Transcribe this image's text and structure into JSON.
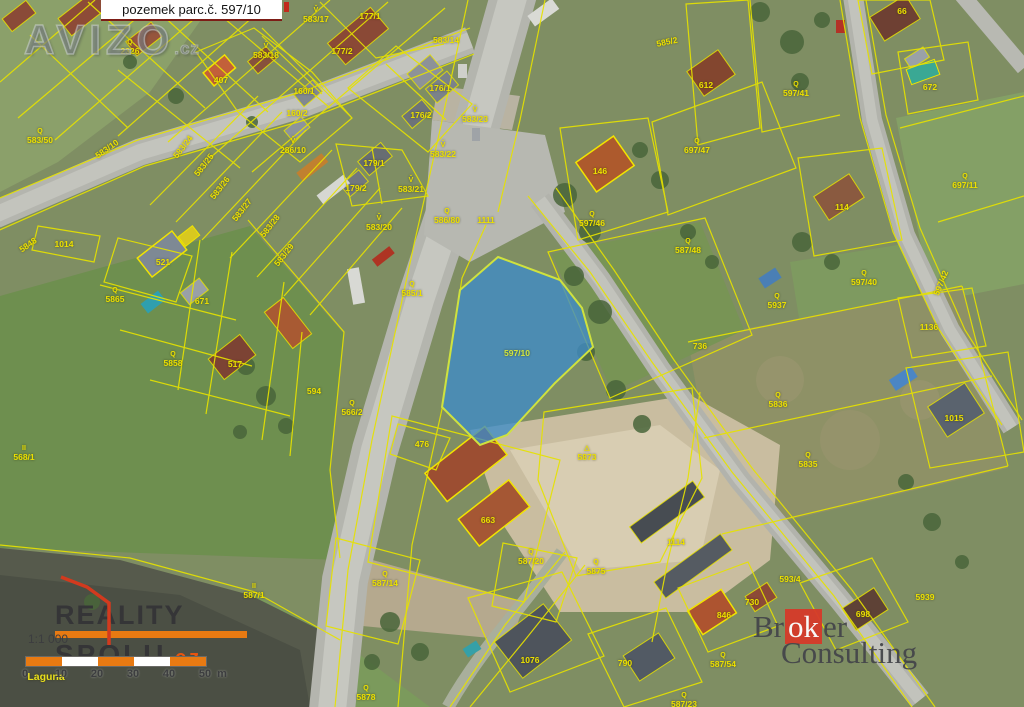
{
  "title_box": {
    "text": "pozemek parc.č. 597/10"
  },
  "watermark": {
    "brand": "AVIZO",
    "tld": ".cz"
  },
  "map": {
    "highlighted_parcel": "597/10",
    "colors": {
      "parcel_line": "#e6e200",
      "highlight_fill": "#3e8cc8",
      "highlight_stroke": "#cfe23e",
      "label": "#ece000"
    },
    "labels": [
      {
        "t": "2326",
        "x": 130,
        "y": 47,
        "s": "Q"
      },
      {
        "t": "583/50",
        "x": 40,
        "y": 136,
        "s": "Q"
      },
      {
        "t": "583/10",
        "x": 107,
        "y": 149,
        "r": -35
      },
      {
        "t": "583/17",
        "x": 316,
        "y": 15,
        "s": "V̌"
      },
      {
        "t": "177/1",
        "x": 370,
        "y": 16
      },
      {
        "t": "583/18",
        "x": 266,
        "y": 51,
        "s": "V̌"
      },
      {
        "t": "177/2",
        "x": 342,
        "y": 51
      },
      {
        "t": "407",
        "x": 221,
        "y": 80
      },
      {
        "t": "160/1",
        "x": 304,
        "y": 91
      },
      {
        "t": "160/2",
        "x": 297,
        "y": 113
      },
      {
        "t": "176/1",
        "x": 440,
        "y": 88
      },
      {
        "t": "176/2",
        "x": 421,
        "y": 115
      },
      {
        "t": "583/23",
        "x": 475,
        "y": 115,
        "s": "V̌"
      },
      {
        "t": "583/14",
        "x": 446,
        "y": 40
      },
      {
        "t": "585/2",
        "x": 667,
        "y": 42,
        "r": -12
      },
      {
        "t": "583/22",
        "x": 443,
        "y": 150,
        "s": "V̌"
      },
      {
        "t": "179/1",
        "x": 374,
        "y": 163
      },
      {
        "t": "179/2",
        "x": 356,
        "y": 188
      },
      {
        "t": "583/21",
        "x": 411,
        "y": 185,
        "s": "V̌"
      },
      {
        "t": "583/20",
        "x": 379,
        "y": 223,
        "s": "V̌"
      },
      {
        "t": "586/80",
        "x": 447,
        "y": 216,
        "s": "Q"
      },
      {
        "t": "1111",
        "x": 486,
        "y": 220
      },
      {
        "t": "585/1",
        "x": 412,
        "y": 289,
        "s": "Q"
      },
      {
        "t": "566/2",
        "x": 352,
        "y": 408,
        "s": "Q"
      },
      {
        "t": "568/1",
        "x": 24,
        "y": 453,
        "s": "II"
      },
      {
        "t": "587/1",
        "x": 254,
        "y": 591,
        "s": "II"
      },
      {
        "t": "1014",
        "x": 64,
        "y": 244
      },
      {
        "t": "5848",
        "x": 28,
        "y": 245,
        "r": -35
      },
      {
        "t": "583/24",
        "x": 183,
        "y": 147,
        "r": -52
      },
      {
        "t": "583/25",
        "x": 204,
        "y": 165,
        "r": -52
      },
      {
        "t": "583/26",
        "x": 220,
        "y": 188,
        "r": -52
      },
      {
        "t": "583/27",
        "x": 242,
        "y": 210,
        "r": -52
      },
      {
        "t": "583/28",
        "x": 270,
        "y": 226,
        "r": -52
      },
      {
        "t": "583/29",
        "x": 284,
        "y": 255,
        "r": -52
      },
      {
        "t": "286/10",
        "x": 293,
        "y": 146,
        "s": "V̌"
      },
      {
        "t": "5865",
        "x": 115,
        "y": 295,
        "s": "Q"
      },
      {
        "t": "671",
        "x": 202,
        "y": 301
      },
      {
        "t": "5858",
        "x": 173,
        "y": 359,
        "s": "Q"
      },
      {
        "t": "517",
        "x": 235,
        "y": 364
      },
      {
        "t": "594",
        "x": 314,
        "y": 391
      },
      {
        "t": "521",
        "x": 163,
        "y": 262
      },
      {
        "t": "146",
        "x": 600,
        "y": 171
      },
      {
        "t": "697/47",
        "x": 697,
        "y": 146,
        "s": "Q"
      },
      {
        "t": "597/46",
        "x": 592,
        "y": 219,
        "s": "Q"
      },
      {
        "t": "587/48",
        "x": 688,
        "y": 246,
        "s": "Q"
      },
      {
        "t": "612",
        "x": 706,
        "y": 85
      },
      {
        "t": "597/41",
        "x": 796,
        "y": 89,
        "s": "Q"
      },
      {
        "t": "66",
        "x": 902,
        "y": 11
      },
      {
        "t": "672",
        "x": 930,
        "y": 87
      },
      {
        "t": "697/11",
        "x": 965,
        "y": 181,
        "s": "Q"
      },
      {
        "t": "114",
        "x": 842,
        "y": 207
      },
      {
        "t": "597/40",
        "x": 864,
        "y": 278,
        "s": "Q"
      },
      {
        "t": "5937",
        "x": 777,
        "y": 301,
        "s": "Q"
      },
      {
        "t": "1136",
        "x": 929,
        "y": 327
      },
      {
        "t": "597/42",
        "x": 941,
        "y": 283,
        "r": -68
      },
      {
        "t": "5836",
        "x": 778,
        "y": 400,
        "s": "Q"
      },
      {
        "t": "5835",
        "x": 808,
        "y": 460,
        "s": "Q"
      },
      {
        "t": "1015",
        "x": 954,
        "y": 418
      },
      {
        "t": "736",
        "x": 700,
        "y": 346
      },
      {
        "t": "5873",
        "x": 587,
        "y": 453,
        "s": "△"
      },
      {
        "t": "5875",
        "x": 596,
        "y": 567,
        "s": "Q"
      },
      {
        "t": "587/20",
        "x": 531,
        "y": 557,
        "s": "Q"
      },
      {
        "t": "663",
        "x": 488,
        "y": 520
      },
      {
        "t": "476",
        "x": 422,
        "y": 444
      },
      {
        "t": "587/14",
        "x": 385,
        "y": 579,
        "s": "Q"
      },
      {
        "t": "1114",
        "x": 676,
        "y": 542
      },
      {
        "t": "5878",
        "x": 366,
        "y": 693,
        "s": "Q"
      },
      {
        "t": "1076",
        "x": 530,
        "y": 660
      },
      {
        "t": "790",
        "x": 625,
        "y": 663
      },
      {
        "t": "846",
        "x": 724,
        "y": 615
      },
      {
        "t": "587/54",
        "x": 723,
        "y": 660,
        "s": "Q"
      },
      {
        "t": "587/23",
        "x": 684,
        "y": 700,
        "s": "Q"
      },
      {
        "t": "698",
        "x": 863,
        "y": 614
      },
      {
        "t": "5939",
        "x": 925,
        "y": 597
      },
      {
        "t": "593/4",
        "x": 790,
        "y": 579
      },
      {
        "t": "730",
        "x": 752,
        "y": 602
      },
      {
        "t": "597/10",
        "x": 517,
        "y": 353,
        "cls": "hl"
      },
      {
        "t": "Laguna",
        "x": 46,
        "y": 677,
        "cls": "place"
      }
    ]
  },
  "scale": {
    "ratio": "1:1 000",
    "ticks": [
      "0",
      "10",
      "20",
      "30",
      "40",
      "50"
    ],
    "unit": "m",
    "bar_colors": [
      "#e87a12",
      "#ffffff",
      "#e87a12",
      "#ffffff",
      "#e87a12"
    ]
  },
  "logos": {
    "reality": {
      "line1": "REALITY",
      "line2": "SPOLU",
      "tld": ".cz"
    },
    "broker": {
      "pre": "Br",
      "mid": "ok",
      "post": "er",
      "line2": "Consulting"
    }
  }
}
